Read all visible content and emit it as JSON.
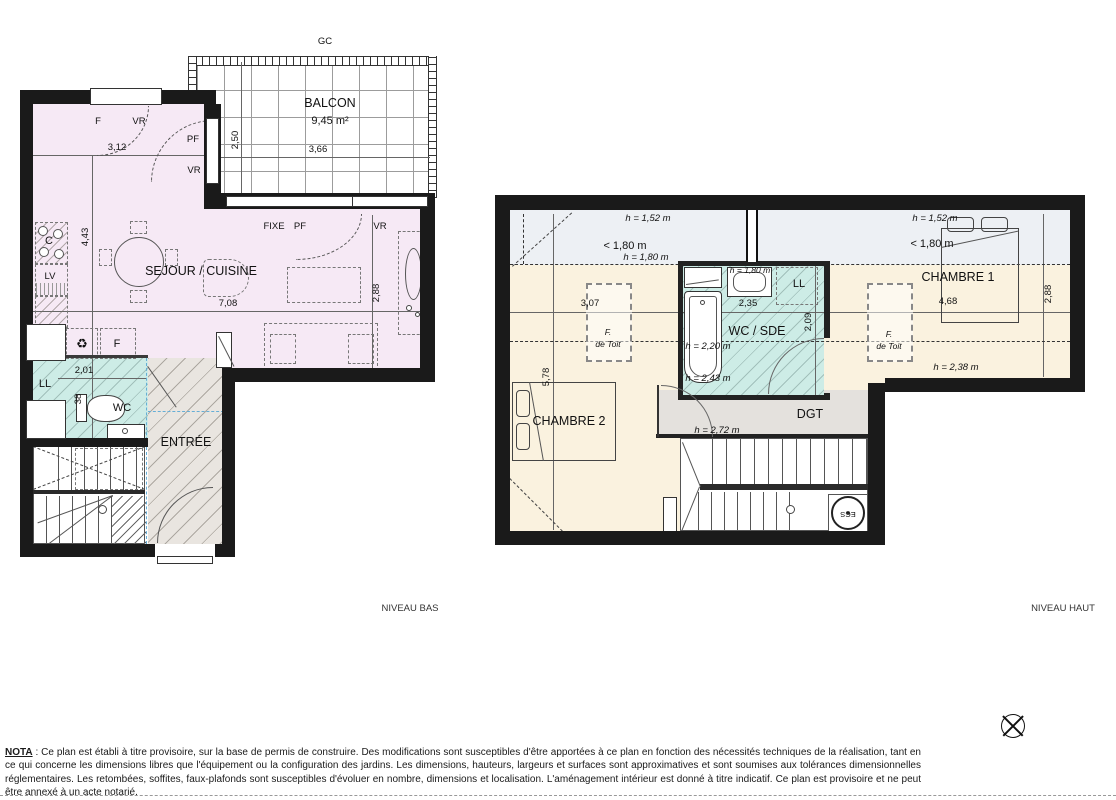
{
  "titles": {
    "niveau_bas": "NIVEAU BAS",
    "niveau_haut": "NIVEAU HAUT"
  },
  "glossary": {
    "gc": "GC",
    "f": "F",
    "vr": "VR",
    "pf": "PF",
    "fixe": "FIXE",
    "ll": "LL",
    "lv": "LV",
    "c": "C",
    "wc": "WC",
    "ecs": "ECS",
    "f_toit_1": "F.",
    "f_toit_2": "de Toit"
  },
  "icons": {
    "recycle": "♻"
  },
  "rooms": {
    "balcon": "BALCON",
    "balcon_area": "9,45 m²",
    "sejour": "SEJOUR / CUISINE",
    "entree": "ENTRÉE",
    "wc_sde": "WC / SDE",
    "chambre1": "CHAMBRE 1",
    "chambre2": "CHAMBRE 2",
    "dgt": "DGT"
  },
  "dims_bas": {
    "d250": "2,50",
    "d366": "3,66",
    "d312": "3,12",
    "d443": "4,43",
    "d708": "7,08",
    "d288": "2,88",
    "d201": "2,01",
    "d38": "38"
  },
  "dims_haut": {
    "d307": "3,07",
    "d578": "5,78",
    "d235": "2,35",
    "d209": "2,09",
    "d468": "4,68",
    "d288": "2,88"
  },
  "heights": {
    "h152": "h = 1,52 m",
    "h180": "h = 1,80 m",
    "lt180": "< 1,80 m",
    "h220": "h = 2,20 m",
    "h243": "h = 2,43 m",
    "h238": "h = 2,38 m",
    "h272": "h = 2,72 m"
  },
  "nota": {
    "label": "NOTA",
    "text": " : Ce plan est établi à titre provisoire, sur la base de permis de construire. Des modifications sont susceptibles d'être apportées à ce plan en fonction des nécessités techniques de la réalisation, tant en ce qui concerne les dimensions libres que l'équipement ou la configuration des jardins. Les dimensions, hauteurs, largeurs et surfaces sont approximatives et sont soumises aux tolérances dimensionnelles réglementaires. Les retombées, soffites, faux-plafonds sont susceptibles d'évoluer en nombre, dimensions et localisation. L'aménagement intérieur est donné à titre indicatif. Ce plan est provisoire et ne peut être annexé à un acte notarié."
  }
}
